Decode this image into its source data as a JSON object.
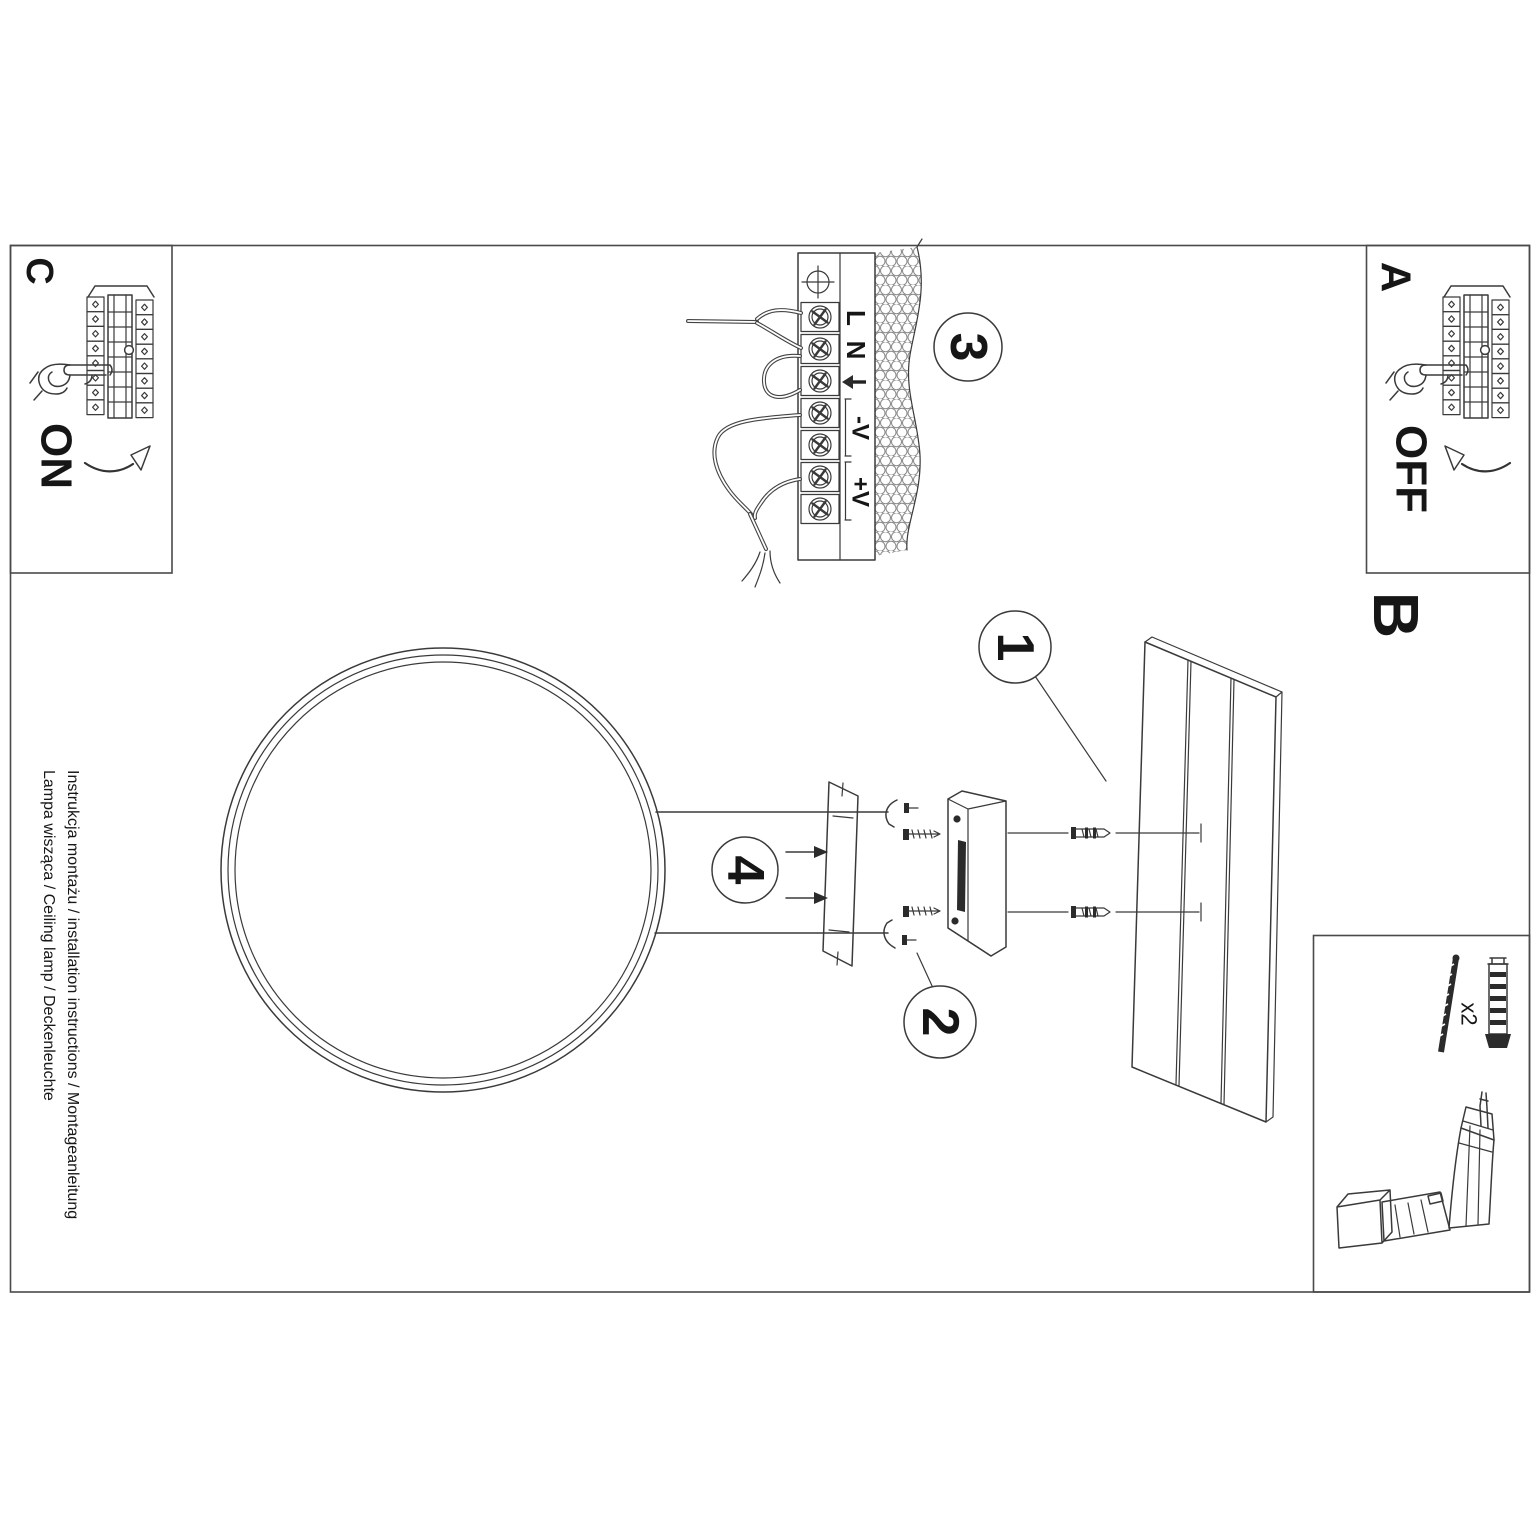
{
  "sheet": {
    "ink_color": "#3a3a3a",
    "title_lines": {
      "line1": "Instrukcja montażu / installation instructions / Montageanleitung",
      "line2": "Lampa wisząca / Ceiling lamp / Deckenleuchte"
    },
    "sections": {
      "a": {
        "label": "A",
        "state": "OFF"
      },
      "b": {
        "label": "B"
      },
      "c": {
        "label": "C",
        "state": "ON"
      }
    },
    "callouts": {
      "c1": "1",
      "c2": "2",
      "c3": "3",
      "c4": "4"
    },
    "terminal_block": {
      "l": "L",
      "n": "N",
      "v_minus": "-V",
      "v_plus": "+V"
    },
    "hardware": {
      "quantity": "x2"
    }
  }
}
